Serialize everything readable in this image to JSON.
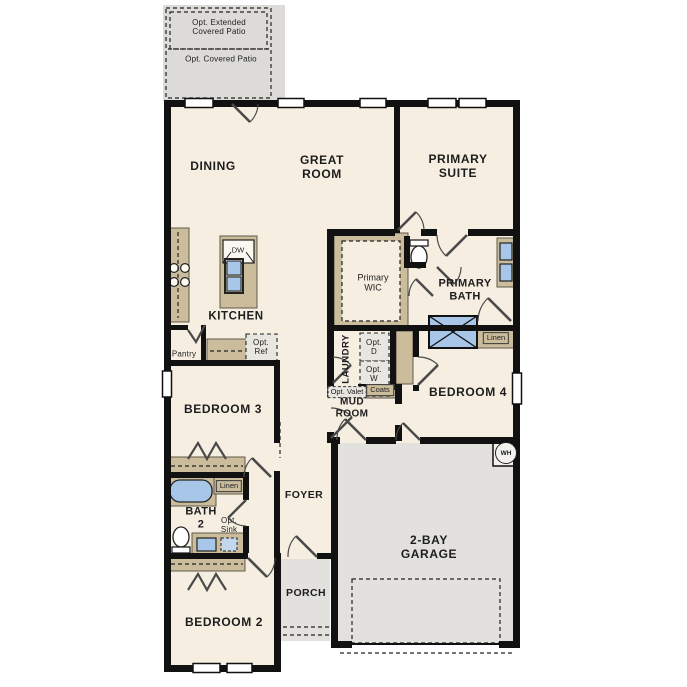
{
  "plan_title": "single-story floor plan",
  "colors": {
    "floor": "#f6efe1",
    "wall": "#111111",
    "cabinet_tan": "#cbbc9c",
    "fixture_blue": "#a7c6e8",
    "garage_gray": "#e2e1de",
    "patio_gray": "#dcdbd8",
    "optional_fill": "#e7e6e0"
  },
  "labels": {
    "opt_extended_patio": "Opt. Extended\nCovered Patio",
    "opt_covered_patio": "Opt. Covered Patio",
    "dining": "DINING",
    "great_room": "GREAT\nROOM",
    "primary_suite": "PRIMARY\nSUITE",
    "kitchen": "KITCHEN",
    "dishwasher": "DW",
    "pantry": "Pantry",
    "opt_ref": "Opt.\nRef",
    "primary_wic": "Primary\nWIC",
    "primary_bath": "PRIMARY\nBATH",
    "linen_primary": "Linen",
    "laundry": "LAUNDRY",
    "opt_dryer": "Opt.\nD",
    "opt_washer": "Opt.\nW",
    "opt_valet": "Opt. Valet",
    "coats": "Coats",
    "mud_room": "MUD\nROOM",
    "bedroom_4": "BEDROOM 4",
    "bedroom_3": "BEDROOM 3",
    "linen_bath2": "Linen",
    "bath_2": "BATH\n2",
    "opt_sink": "Opt.\nSink",
    "foyer": "FOYER",
    "porch": "PORCH",
    "garage": "2-BAY\nGARAGE",
    "water_heater": "WH",
    "bedroom_2": "BEDROOM 2"
  }
}
